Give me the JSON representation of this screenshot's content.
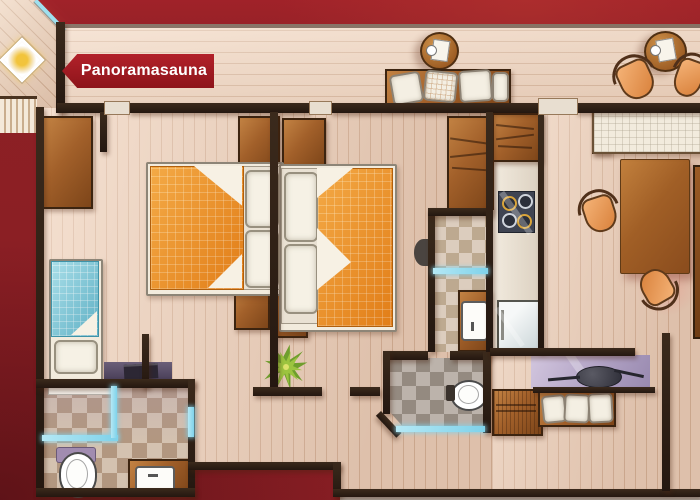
{
  "sign": {
    "text": "Panoramasauna"
  },
  "palette": {
    "background_red": "#8e2025",
    "sign_red": "#a31b21",
    "sign_text": "#ffffff",
    "wall_dark": "#33241a",
    "floor_wood": "#e9d3c1",
    "terrace_wood": "#eed9c8",
    "furniture_wood": "#a2602a",
    "duvet_orange": "#ec8c1e",
    "duvet_blue": "#72c3d6",
    "chair_orange": "#e8955a",
    "glass_blue": "#7fd2ea",
    "tile_beige": "#d4c2b0",
    "tile_gray": "#bcb3ab",
    "desk_lavender": "#b1a2c4",
    "plant_green": "#7aa832"
  },
  "areas": [
    "panorama-sauna",
    "terrace",
    "bedroom-1",
    "bedroom-2",
    "single-bedroom",
    "bathroom",
    "shower-room",
    "wc",
    "kitchen",
    "living-dining-area",
    "hallway"
  ],
  "furniture": [
    "double-bed",
    "double-bed",
    "single-bed",
    "wardrobe",
    "wardrobe",
    "round-table",
    "round-table",
    "terrace-bench",
    "dining-table",
    "orange-chair",
    "orange-chair",
    "orange-chair",
    "orange-chair",
    "cooktop",
    "fridge",
    "sink",
    "sink",
    "toilet",
    "toilet",
    "desk-with-laptop",
    "tv-sideboard",
    "cushion-bench",
    "plant",
    "sauna-skylight",
    "sauna-bench"
  ]
}
